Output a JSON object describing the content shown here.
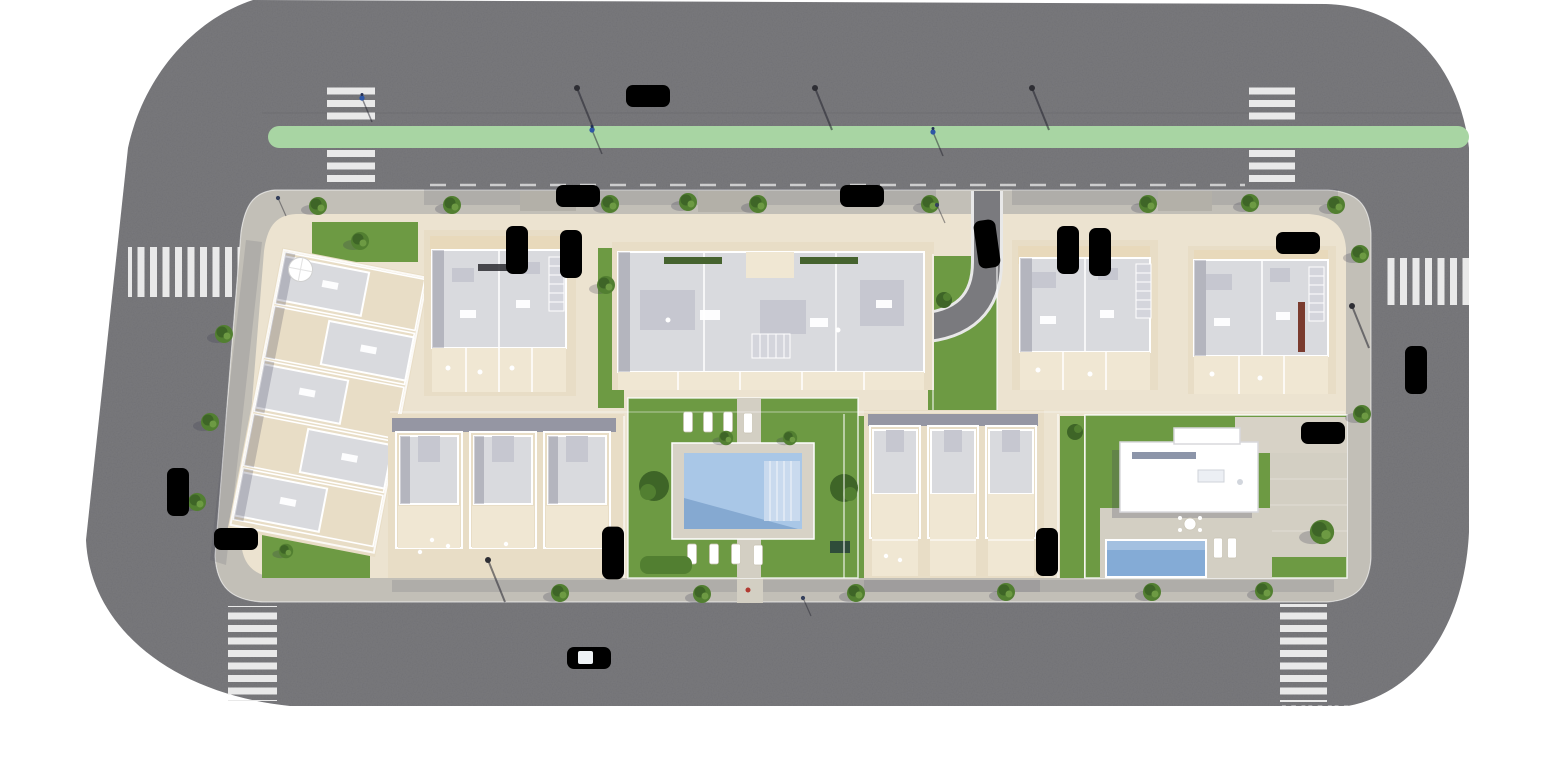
{
  "scene": {
    "type": "aerial-architectural-render",
    "subject": "Top-down render of a residential development block ringed by a perimeter road",
    "watermark": "www"
  },
  "colors": {
    "background": "#ffffff",
    "road": "#7a7a7e",
    "road_seam": "#5e5e63",
    "sidewalk": "#c2bfb7",
    "entry_paving": "#b3b0a8",
    "block_paving": "#ece3d0",
    "plot_paving": "#e8ddc6",
    "terrace": "#f0e7d3",
    "pool_deck": "#d7d2c6",
    "path_paving": "#d3cfc3",
    "lawn": "#6d9a43",
    "lawn_dark": "#527f31",
    "shrub": "#3e6527",
    "planter": "#46632f",
    "bike_lane": "#a8d5a3",
    "crosswalk": "#e9e9e9",
    "roof_light": "#d9dade",
    "roof_mid": "#c6c7d0",
    "wall_cream": "#e8d9bb",
    "wall_shadow": "#9596a3",
    "shade": "rgba(62,62,88,0.24)",
    "pool_water": "#a9c7e7",
    "pool_water_dark": "#7fa3cd",
    "pool_steps": "#c9daee",
    "villa_pool": "#84abd6",
    "car_white": "#f4f4f4",
    "car_glass": "#3c4754",
    "car_blue": "#2d56a6",
    "car_navy": "#232f55",
    "car_black": "#232328",
    "lamp_dark": "#2e2e34",
    "person": "#35405c",
    "chimney": "#7a3b2e",
    "watermark_color": "rgba(255,255,255,0.75)"
  },
  "legend": {
    "buildings": 8,
    "zebra_crosswalks": 6,
    "vehicles": 16,
    "street_lamps": 5,
    "cyclists": 3,
    "pools": 2,
    "sun_loungers": 10
  }
}
